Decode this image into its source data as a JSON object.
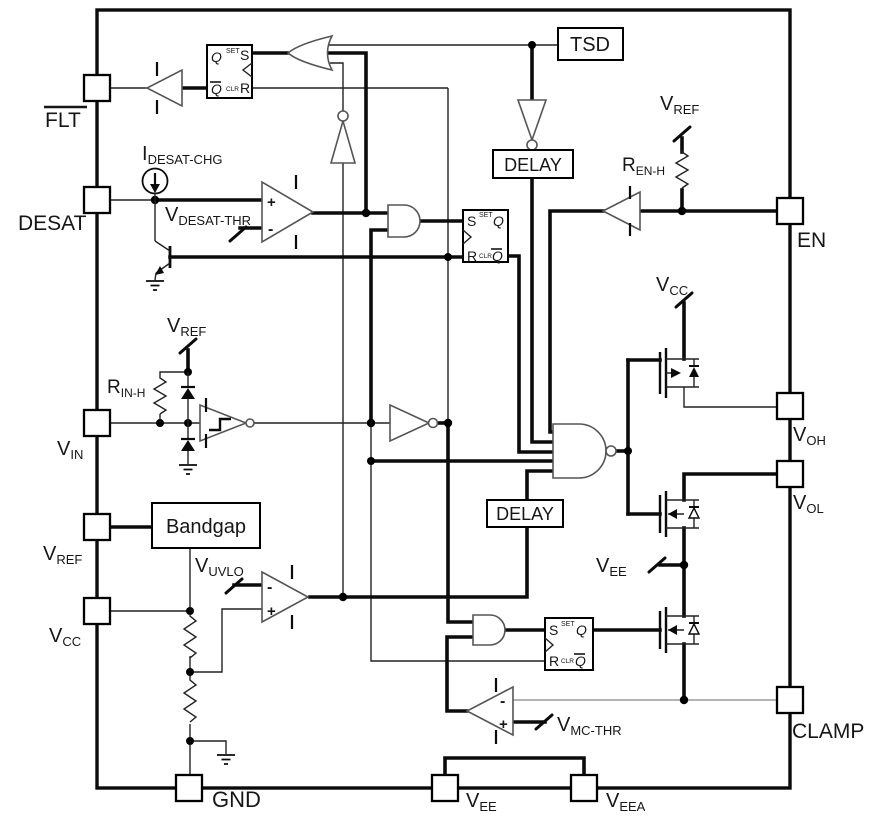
{
  "colors": {
    "wire": "#0b0b0b",
    "gate_outline": "#555555",
    "gray_wire": "#9a9a9a",
    "background": "#ffffff"
  },
  "blocks": {
    "tsd": "TSD",
    "delay": "DELAY",
    "bandgap": "Bandgap"
  },
  "pins": {
    "flt": "FLT",
    "desat": "DESAT",
    "vin": {
      "main": "V",
      "sub": "IN"
    },
    "vref": {
      "main": "V",
      "sub": "REF"
    },
    "vcc": {
      "main": "V",
      "sub": "CC"
    },
    "gnd": "GND",
    "vee": {
      "main": "V",
      "sub": "EE"
    },
    "veea": {
      "main": "V",
      "sub": "EEA"
    },
    "en": "EN",
    "voh": {
      "main": "V",
      "sub": "OH"
    },
    "vol": {
      "main": "V",
      "sub": "OL"
    },
    "clamp": "CLAMP"
  },
  "nets": {
    "idesat_chg": {
      "main": "I",
      "sub": "DESAT-CHG"
    },
    "vdesat_thr": {
      "main": "V",
      "sub": "DESAT-THR"
    },
    "rin_h": {
      "main": "R",
      "sub": "IN-H"
    },
    "ren_h": {
      "main": "R",
      "sub": "EN-H"
    },
    "vuvlo": {
      "main": "V",
      "sub": "UVLO"
    },
    "vmc_thr": {
      "main": "V",
      "sub": "MC-THR"
    }
  },
  "latch": {
    "s": "S",
    "r": "R",
    "q": "Q",
    "q_bar": "Q",
    "set": "SET",
    "clr": "CLR"
  },
  "comparator": {
    "plus": "+",
    "minus": "-"
  }
}
